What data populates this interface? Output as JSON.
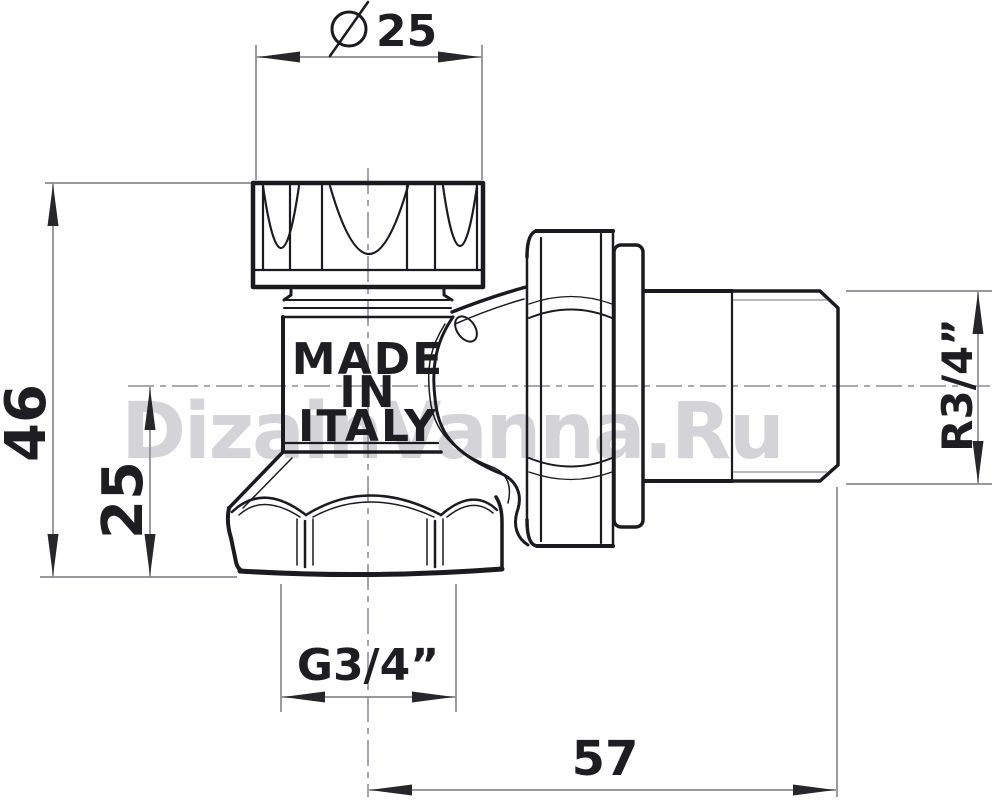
{
  "watermark": "DizainVanna.Ru",
  "drawing": {
    "marking": {
      "line1": "MADE",
      "line2": "IN",
      "line3": "ITALY"
    },
    "dimensions": {
      "cap_diameter": {
        "symbol": "⌀",
        "value": "25"
      },
      "height": "46",
      "center_offset": "25",
      "bottom_thread": "G3/4”",
      "length": "57",
      "side_thread": "R3/4”"
    },
    "colors": {
      "line": "#1b1b1f",
      "dimension_line": "#8a8a90",
      "centerline": "#8e8e94",
      "thread_relief": "#a0a0a6",
      "text": "#1e1e22",
      "watermark": "#d4d4d8",
      "background": "#ffffff"
    }
  }
}
